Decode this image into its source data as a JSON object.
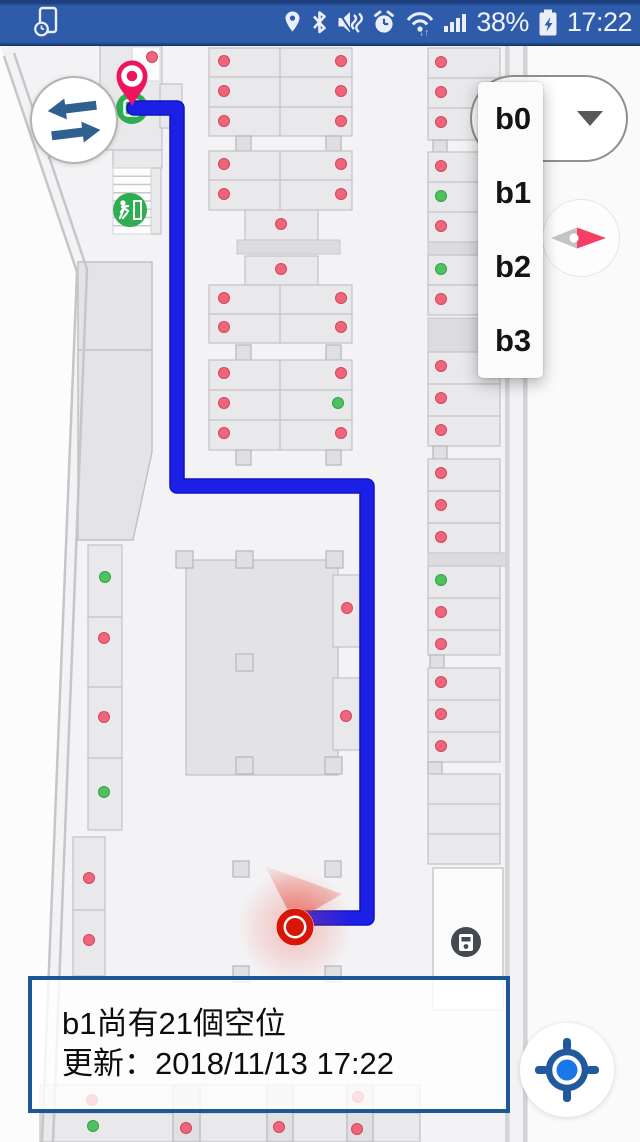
{
  "status_bar": {
    "time": "17:22",
    "battery_percent": "38%",
    "left_icon": "screen-timeout-icon",
    "right_icons": [
      "location-icon",
      "bluetooth-icon",
      "mute-vibrate-icon",
      "alarm-icon",
      "wifi-icon",
      "signal-icon",
      "battery-icon"
    ],
    "bg_color": "#2e5cab"
  },
  "floor_selector": {
    "selected": "b0",
    "options": [
      "b0",
      "b1",
      "b2",
      "b3"
    ]
  },
  "info_box": {
    "line1": "b1尚有21個空位",
    "line2": "更新：2018/11/13 17:22",
    "border_color": "#1f5796"
  },
  "colors": {
    "route": "#1c1fe6",
    "route_edge": "#1113c0",
    "occupied_dot": "#f0657b",
    "free_dot": "#4fc160",
    "marker_red": "#d81507",
    "pin_pink": "#ee1560",
    "exit_green": "#2fad53",
    "accent_blue": "#20599c",
    "locate_dot": "#1b76e9",
    "swap_arrow": "#30608f",
    "compass_needle": "#f53f63"
  },
  "map": {
    "bg": "#f3f3f5",
    "outside_left": "0,44 4,56 77,272 42,1142 0,1142",
    "outside_right": [
      528,
      44,
      112,
      1098
    ],
    "walls": [
      "4,56 77,272 42,1142",
      "14,53 87,269 53,1142"
    ],
    "right_wall_x": [
      505,
      523
    ],
    "ramp": "78,262 152,262 152,452 133,540 78,540",
    "ramp_divider_y": 350,
    "stairs": {
      "x": 113,
      "y": 168,
      "w": 38,
      "h": 66,
      "treads": 7
    },
    "rects": [
      [
        "s",
        100,
        46,
        62,
        104
      ],
      [
        "w",
        132,
        47,
        28,
        34
      ],
      [
        "s",
        160,
        84,
        22,
        44
      ],
      [
        "s",
        113,
        150,
        49,
        18
      ],
      [
        "s",
        151,
        168,
        10,
        66
      ],
      [
        "s",
        209,
        48,
        71,
        29
      ],
      [
        "s",
        280,
        48,
        72,
        29
      ],
      [
        "s",
        209,
        77,
        71,
        30
      ],
      [
        "s",
        280,
        77,
        72,
        30
      ],
      [
        "s",
        209,
        107,
        71,
        29
      ],
      [
        "s",
        280,
        107,
        72,
        29
      ],
      [
        "p",
        236,
        136,
        15,
        15
      ],
      [
        "p",
        326,
        136,
        15,
        15
      ],
      [
        "s",
        209,
        151,
        71,
        29
      ],
      [
        "s",
        280,
        151,
        72,
        29
      ],
      [
        "s",
        209,
        180,
        71,
        30
      ],
      [
        "s",
        280,
        180,
        72,
        30
      ],
      [
        "s",
        245,
        210,
        73,
        30
      ],
      [
        "b",
        237,
        240,
        103,
        14
      ],
      [
        "s",
        245,
        256,
        73,
        29
      ],
      [
        "s",
        209,
        285,
        71,
        29
      ],
      [
        "s",
        280,
        285,
        72,
        29
      ],
      [
        "s",
        209,
        314,
        71,
        29
      ],
      [
        "s",
        280,
        314,
        72,
        29
      ],
      [
        "p",
        236,
        345,
        15,
        15
      ],
      [
        "p",
        326,
        345,
        15,
        15
      ],
      [
        "s",
        209,
        360,
        71,
        30
      ],
      [
        "s",
        280,
        360,
        72,
        30
      ],
      [
        "s",
        209,
        390,
        71,
        30
      ],
      [
        "s",
        280,
        390,
        72,
        30
      ],
      [
        "s",
        209,
        420,
        71,
        30
      ],
      [
        "s",
        280,
        420,
        72,
        30
      ],
      [
        "p",
        236,
        450,
        15,
        15
      ],
      [
        "p",
        326,
        450,
        15,
        15
      ],
      [
        "c",
        186,
        560,
        152,
        215
      ],
      [
        "p",
        176,
        551,
        17,
        17
      ],
      [
        "p",
        236,
        551,
        17,
        17
      ],
      [
        "p",
        326,
        551,
        17,
        17
      ],
      [
        "p",
        236,
        654,
        17,
        17
      ],
      [
        "p",
        236,
        757,
        17,
        17
      ],
      [
        "p",
        325,
        757,
        17,
        17
      ],
      [
        "s",
        333,
        575,
        28,
        72
      ],
      [
        "s",
        333,
        678,
        28,
        72
      ],
      [
        "s",
        88,
        545,
        34,
        72
      ],
      [
        "s",
        88,
        617,
        34,
        70
      ],
      [
        "s",
        88,
        687,
        34,
        71
      ],
      [
        "s",
        88,
        758,
        34,
        72
      ],
      [
        "s",
        73,
        837,
        32,
        73
      ],
      [
        "s",
        73,
        910,
        32,
        66
      ],
      [
        "p",
        233,
        861,
        16,
        16
      ],
      [
        "p",
        325,
        861,
        16,
        16
      ],
      [
        "p",
        233,
        966,
        16,
        16
      ],
      [
        "p",
        325,
        966,
        16,
        16
      ],
      [
        "s",
        40,
        1085,
        380,
        28
      ],
      [
        "s",
        40,
        1113,
        380,
        29
      ],
      [
        "p",
        173,
        1085,
        27,
        57
      ],
      [
        "p",
        267,
        1085,
        26,
        57
      ],
      [
        "p",
        347,
        1085,
        26,
        57
      ],
      [
        "s",
        428,
        48,
        72,
        30
      ],
      [
        "s",
        428,
        78,
        72,
        30
      ],
      [
        "s",
        428,
        108,
        72,
        32
      ],
      [
        "p",
        433,
        140,
        14,
        12
      ],
      [
        "s",
        428,
        152,
        72,
        30
      ],
      [
        "s",
        428,
        182,
        72,
        30
      ],
      [
        "s",
        428,
        212,
        72,
        30
      ],
      [
        "b",
        428,
        242,
        72,
        13
      ],
      [
        "s",
        428,
        255,
        72,
        30
      ],
      [
        "s",
        428,
        285,
        72,
        30
      ],
      [
        "b",
        428,
        318,
        72,
        34
      ],
      [
        "s",
        428,
        352,
        72,
        32
      ],
      [
        "s",
        428,
        384,
        72,
        32
      ],
      [
        "s",
        428,
        416,
        72,
        30
      ],
      [
        "p",
        433,
        446,
        14,
        13
      ],
      [
        "s",
        428,
        459,
        72,
        32
      ],
      [
        "s",
        428,
        491,
        72,
        32
      ],
      [
        "s",
        428,
        523,
        72,
        30
      ],
      [
        "b",
        428,
        553,
        79,
        13
      ],
      [
        "s",
        428,
        566,
        72,
        32
      ],
      [
        "s",
        428,
        598,
        72,
        32
      ],
      [
        "s",
        428,
        630,
        72,
        25
      ],
      [
        "p",
        430,
        655,
        14,
        13
      ],
      [
        "s",
        428,
        668,
        72,
        32
      ],
      [
        "s",
        428,
        700,
        72,
        32
      ],
      [
        "s",
        428,
        732,
        72,
        30
      ],
      [
        "p",
        428,
        762,
        14,
        12
      ],
      [
        "s",
        428,
        774,
        72,
        30
      ],
      [
        "s",
        428,
        804,
        72,
        30
      ],
      [
        "s",
        428,
        834,
        72,
        30
      ],
      [
        "room",
        433,
        868,
        70,
        142
      ]
    ],
    "dots": [
      [
        152,
        57,
        "r"
      ],
      [
        224,
        61,
        "r"
      ],
      [
        341,
        61,
        "r"
      ],
      [
        224,
        91,
        "r"
      ],
      [
        341,
        91,
        "r"
      ],
      [
        224,
        121,
        "r"
      ],
      [
        341,
        121,
        "r"
      ],
      [
        224,
        164,
        "r"
      ],
      [
        341,
        164,
        "r"
      ],
      [
        224,
        194,
        "r"
      ],
      [
        341,
        194,
        "r"
      ],
      [
        281,
        224,
        "r"
      ],
      [
        281,
        269,
        "r"
      ],
      [
        224,
        298,
        "r"
      ],
      [
        341,
        298,
        "r"
      ],
      [
        224,
        327,
        "r"
      ],
      [
        341,
        327,
        "r"
      ],
      [
        224,
        373,
        "r"
      ],
      [
        341,
        373,
        "r"
      ],
      [
        224,
        403,
        "r"
      ],
      [
        338,
        403,
        "g"
      ],
      [
        224,
        433,
        "r"
      ],
      [
        341,
        433,
        "r"
      ],
      [
        347,
        608,
        "r"
      ],
      [
        346,
        716,
        "r"
      ],
      [
        105,
        577,
        "g"
      ],
      [
        104,
        638,
        "r"
      ],
      [
        104,
        717,
        "r"
      ],
      [
        104,
        792,
        "g"
      ],
      [
        89,
        878,
        "r"
      ],
      [
        89,
        940,
        "r"
      ],
      [
        92,
        1100,
        "r"
      ],
      [
        358,
        1097,
        "r"
      ],
      [
        93,
        1126,
        "g"
      ],
      [
        186,
        1128,
        "r"
      ],
      [
        279,
        1127,
        "r"
      ],
      [
        357,
        1129,
        "r"
      ],
      [
        441,
        62,
        "r"
      ],
      [
        441,
        92,
        "r"
      ],
      [
        441,
        122,
        "r"
      ],
      [
        441,
        166,
        "r"
      ],
      [
        441,
        196,
        "g"
      ],
      [
        441,
        226,
        "r"
      ],
      [
        441,
        269,
        "g"
      ],
      [
        441,
        299,
        "r"
      ],
      [
        441,
        366,
        "r"
      ],
      [
        441,
        398,
        "r"
      ],
      [
        441,
        430,
        "r"
      ],
      [
        441,
        473,
        "r"
      ],
      [
        441,
        505,
        "r"
      ],
      [
        441,
        537,
        "r"
      ],
      [
        441,
        580,
        "g"
      ],
      [
        441,
        612,
        "r"
      ],
      [
        441,
        644,
        "r"
      ],
      [
        441,
        682,
        "r"
      ],
      [
        441,
        714,
        "r"
      ],
      [
        441,
        746,
        "r"
      ]
    ],
    "route_points": "134,108 177,108 177,486 367,486 367,918 300,918",
    "marker": {
      "x": 295,
      "y": 927
    },
    "cone_points": "294,922 265,866 342,894",
    "pin": {
      "x": 132,
      "y": 106
    },
    "elevator_icon": {
      "x": 132,
      "y": 108
    },
    "exit_icon": {
      "x": 130,
      "y": 210
    },
    "machine_icon": {
      "x": 466,
      "y": 942
    }
  }
}
